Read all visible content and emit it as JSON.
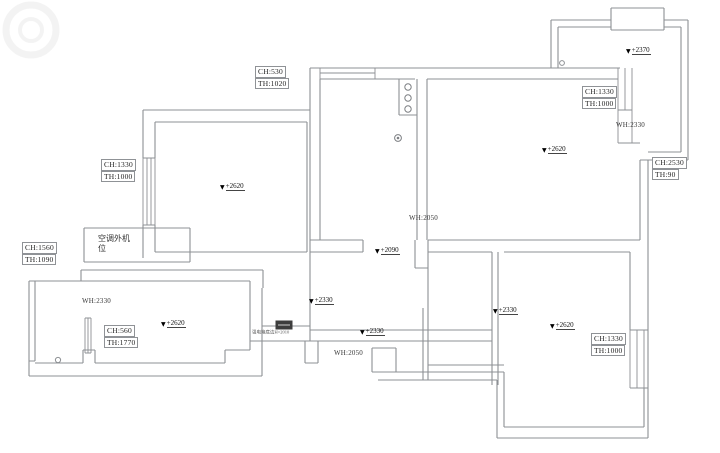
{
  "drawing": {
    "kind": "apartment floor plan with ceiling / sill height annotations"
  },
  "colors": {
    "wall_line": "#8d9094",
    "text": "#2e2e2e",
    "electric_box_fill": "#3d3d3d"
  },
  "boxed_labels": [
    {
      "id": "kitchen-north-window",
      "lines": [
        "CH:530",
        "TH:1020"
      ],
      "x": 255,
      "y": 66
    },
    {
      "id": "bedroom1-west-window",
      "lines": [
        "CH:1330",
        "TH:1000"
      ],
      "x": 101,
      "y": 159
    },
    {
      "id": "west-balcony-window",
      "lines": [
        "CH:1560",
        "TH:1090"
      ],
      "x": 22,
      "y": 242
    },
    {
      "id": "living-west-window",
      "lines": [
        "CH:560",
        "TH:1770"
      ],
      "x": 104,
      "y": 325
    },
    {
      "id": "dining-east-window",
      "lines": [
        "CH:1330",
        "TH:1000"
      ],
      "x": 582,
      "y": 86
    },
    {
      "id": "east-balcony-rail",
      "lines": [
        "CH:2530",
        "TH:90"
      ],
      "x": 652,
      "y": 157
    },
    {
      "id": "bedroom2-east-window",
      "lines": [
        "CH:1330",
        "TH:1000"
      ],
      "x": 591,
      "y": 333
    }
  ],
  "elevation_markers": [
    {
      "id": "bedroom1-ceiling",
      "text": "+2620",
      "x": 220,
      "y": 182
    },
    {
      "id": "dining-ceiling",
      "text": "+2620",
      "x": 542,
      "y": 145
    },
    {
      "id": "balcony-ceiling",
      "text": "+2370",
      "x": 626,
      "y": 46
    },
    {
      "id": "kitchen-doorway",
      "text": "+2090",
      "x": 375,
      "y": 246
    },
    {
      "id": "hall-west",
      "text": "+2330",
      "x": 309,
      "y": 296
    },
    {
      "id": "hall-south",
      "text": "+2330",
      "x": 360,
      "y": 327
    },
    {
      "id": "corridor-east",
      "text": "+2330",
      "x": 493,
      "y": 306
    },
    {
      "id": "living-ceiling",
      "text": "+2620",
      "x": 161,
      "y": 319
    },
    {
      "id": "bedroom2-ceiling",
      "text": "+2620",
      "x": 550,
      "y": 321
    }
  ],
  "width_labels": [
    {
      "id": "living-window-width",
      "text": "WH:2330",
      "x": 82,
      "y": 297
    },
    {
      "id": "dining-window-width",
      "text": "WH:2330",
      "x": 616,
      "y": 121
    },
    {
      "id": "kitchen-opening-width",
      "text": "WH:2050",
      "x": 409,
      "y": 214
    },
    {
      "id": "bath-opening-width",
      "text": "WH:2050",
      "x": 334,
      "y": 349
    }
  ],
  "room_labels": [
    {
      "id": "ac-outdoor-unit",
      "text": "空调外机\n位",
      "x": 98,
      "y": 234
    }
  ],
  "notes": [
    {
      "id": "electric-box-note",
      "text": "强电箱底边H=2010",
      "x": 252,
      "y": 331
    }
  ],
  "symbols": [
    {
      "name": "flue-pipes-icon"
    },
    {
      "name": "floor-drain-icon"
    },
    {
      "name": "balcony-drain-icon"
    },
    {
      "name": "door-hinge-icon"
    },
    {
      "name": "electric-box-icon"
    },
    {
      "name": "watermark-stamp"
    }
  ]
}
